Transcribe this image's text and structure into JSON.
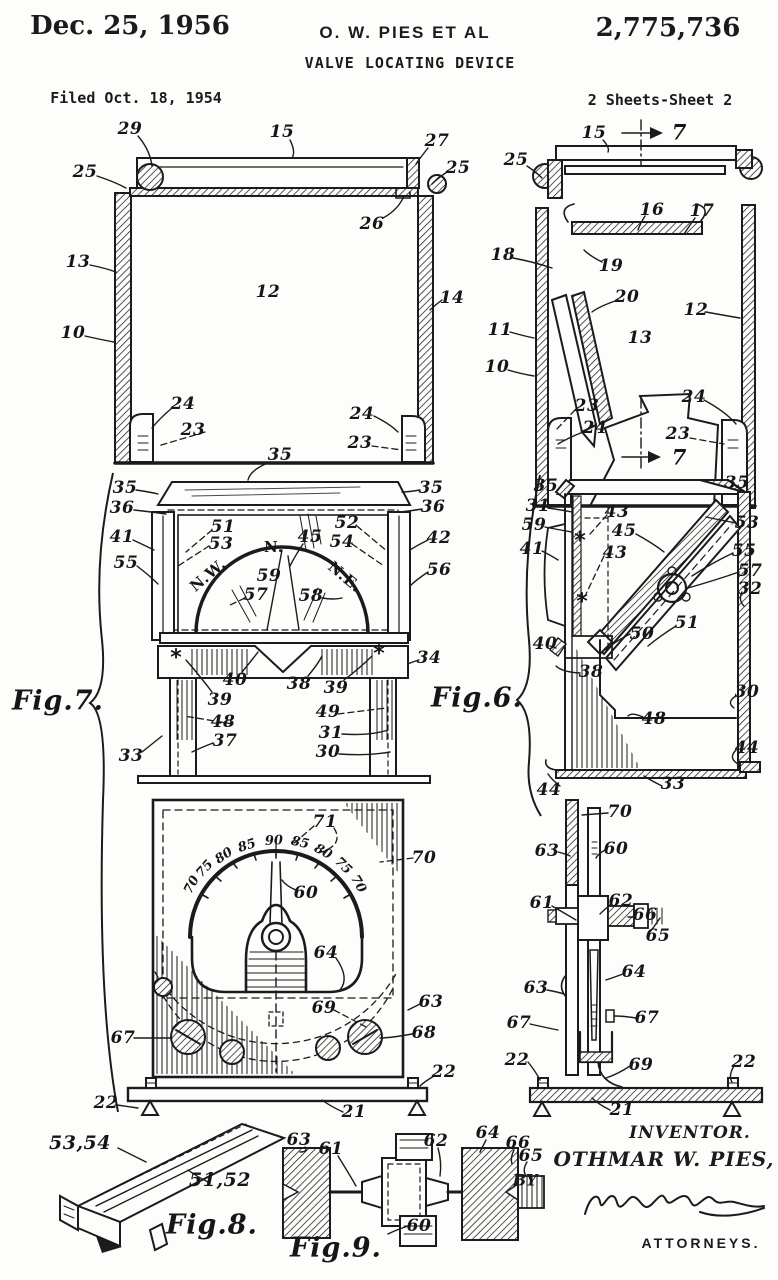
{
  "header": {
    "date": "Dec. 25, 1956",
    "inventor_line": "O. W. PIES ET AL",
    "patent_number": "2,775,736",
    "title": "VALVE LOCATING DEVICE",
    "filed": "Filed Oct. 18, 1954",
    "sheet": "2 Sheets-Sheet 2"
  },
  "inventor_block": {
    "label": "INVENTOR.",
    "name": "OTHMAR W. PIES,",
    "by": "BY",
    "attorneys": "ATTORNEYS."
  },
  "figure_titles": [
    "Fig.7.",
    "Fig.6.",
    "Fig.8.",
    "Fig.9."
  ],
  "labels": [
    {
      "t": "29",
      "x": 130,
      "y": 129
    },
    {
      "t": "15",
      "x": 282,
      "y": 132
    },
    {
      "t": "27",
      "x": 437,
      "y": 141
    },
    {
      "t": "25",
      "x": 85,
      "y": 172
    },
    {
      "t": "25",
      "x": 458,
      "y": 168
    },
    {
      "t": "26",
      "x": 372,
      "y": 224
    },
    {
      "t": "13",
      "x": 78,
      "y": 262
    },
    {
      "t": "12",
      "x": 268,
      "y": 292
    },
    {
      "t": "14",
      "x": 452,
      "y": 298
    },
    {
      "t": "10",
      "x": 73,
      "y": 333
    },
    {
      "t": "24",
      "x": 183,
      "y": 404
    },
    {
      "t": "23",
      "x": 193,
      "y": 430
    },
    {
      "t": "24",
      "x": 362,
      "y": 414
    },
    {
      "t": "23",
      "x": 360,
      "y": 443
    },
    {
      "t": "35",
      "x": 280,
      "y": 455
    },
    {
      "t": "15",
      "x": 594,
      "y": 133
    },
    {
      "t": "7",
      "x": 679,
      "y": 132,
      "c": "sec"
    },
    {
      "t": "25",
      "x": 516,
      "y": 160
    },
    {
      "t": "16",
      "x": 652,
      "y": 210
    },
    {
      "t": "17",
      "x": 702,
      "y": 211
    },
    {
      "t": "18",
      "x": 503,
      "y": 255
    },
    {
      "t": "19",
      "x": 611,
      "y": 266
    },
    {
      "t": "20",
      "x": 627,
      "y": 297
    },
    {
      "t": "12",
      "x": 696,
      "y": 310
    },
    {
      "t": "11",
      "x": 500,
      "y": 330
    },
    {
      "t": "13",
      "x": 640,
      "y": 338
    },
    {
      "t": "10",
      "x": 497,
      "y": 367
    },
    {
      "t": "23",
      "x": 587,
      "y": 406
    },
    {
      "t": "24",
      "x": 595,
      "y": 428
    },
    {
      "t": "24",
      "x": 694,
      "y": 397
    },
    {
      "t": "23",
      "x": 678,
      "y": 434
    },
    {
      "t": "7",
      "x": 679,
      "y": 457,
      "c": "sec"
    },
    {
      "t": "35",
      "x": 125,
      "y": 488
    },
    {
      "t": "36",
      "x": 122,
      "y": 508
    },
    {
      "t": "35",
      "x": 431,
      "y": 488
    },
    {
      "t": "36",
      "x": 433,
      "y": 507
    },
    {
      "t": "41",
      "x": 122,
      "y": 537
    },
    {
      "t": "51",
      "x": 223,
      "y": 527
    },
    {
      "t": "53",
      "x": 221,
      "y": 544
    },
    {
      "t": "45",
      "x": 310,
      "y": 537
    },
    {
      "t": "52",
      "x": 347,
      "y": 523
    },
    {
      "t": "54",
      "x": 342,
      "y": 542
    },
    {
      "t": "42",
      "x": 439,
      "y": 538
    },
    {
      "t": "55",
      "x": 126,
      "y": 563
    },
    {
      "t": "56",
      "x": 439,
      "y": 570
    },
    {
      "t": "N.",
      "x": 274,
      "y": 547,
      "c": "compass"
    },
    {
      "t": "N.W.",
      "x": 208,
      "y": 575,
      "c": "compass",
      "r": -40
    },
    {
      "t": "N.E.",
      "x": 345,
      "y": 577,
      "c": "compass",
      "r": 40
    },
    {
      "t": "59",
      "x": 269,
      "y": 576
    },
    {
      "t": "57",
      "x": 256,
      "y": 595
    },
    {
      "t": "58",
      "x": 311,
      "y": 596
    },
    {
      "t": "*",
      "x": 176,
      "y": 658,
      "c": "mark"
    },
    {
      "t": "*",
      "x": 379,
      "y": 654,
      "c": "mark"
    },
    {
      "t": "34",
      "x": 429,
      "y": 658
    },
    {
      "t": "40",
      "x": 235,
      "y": 680
    },
    {
      "t": "38",
      "x": 299,
      "y": 684
    },
    {
      "t": "39",
      "x": 336,
      "y": 688
    },
    {
      "t": "39",
      "x": 220,
      "y": 700
    },
    {
      "t": "49",
      "x": 328,
      "y": 712
    },
    {
      "t": "48",
      "x": 223,
      "y": 722
    },
    {
      "t": "31",
      "x": 331,
      "y": 733
    },
    {
      "t": "37",
      "x": 225,
      "y": 741
    },
    {
      "t": "30",
      "x": 328,
      "y": 752
    },
    {
      "t": "33",
      "x": 131,
      "y": 756
    },
    {
      "t": "Fig.7.",
      "x": 58,
      "y": 701,
      "c": "fig"
    },
    {
      "t": "Fig.6.",
      "x": 477,
      "y": 698,
      "c": "fig"
    },
    {
      "t": "35",
      "x": 546,
      "y": 486
    },
    {
      "t": "35",
      "x": 737,
      "y": 483
    },
    {
      "t": "31",
      "x": 538,
      "y": 506
    },
    {
      "t": "59",
      "x": 534,
      "y": 525
    },
    {
      "t": "41",
      "x": 532,
      "y": 549
    },
    {
      "t": "43",
      "x": 617,
      "y": 512
    },
    {
      "t": "45",
      "x": 624,
      "y": 531
    },
    {
      "t": "43",
      "x": 615,
      "y": 553
    },
    {
      "t": "53",
      "x": 747,
      "y": 523
    },
    {
      "t": "55",
      "x": 744,
      "y": 551
    },
    {
      "t": "57",
      "x": 750,
      "y": 571
    },
    {
      "t": "32",
      "x": 750,
      "y": 589
    },
    {
      "t": "*",
      "x": 580,
      "y": 541,
      "c": "mark"
    },
    {
      "t": "*",
      "x": 582,
      "y": 602,
      "c": "mark"
    },
    {
      "t": "51",
      "x": 687,
      "y": 623
    },
    {
      "t": "50",
      "x": 642,
      "y": 634
    },
    {
      "t": "40",
      "x": 545,
      "y": 644
    },
    {
      "t": "38",
      "x": 591,
      "y": 672
    },
    {
      "t": "30",
      "x": 747,
      "y": 692
    },
    {
      "t": "48",
      "x": 654,
      "y": 719
    },
    {
      "t": "44",
      "x": 747,
      "y": 748
    },
    {
      "t": "33",
      "x": 673,
      "y": 784
    },
    {
      "t": "44",
      "x": 549,
      "y": 790
    },
    {
      "t": "70",
      "x": 620,
      "y": 812
    },
    {
      "t": "63",
      "x": 547,
      "y": 851
    },
    {
      "t": "60",
      "x": 616,
      "y": 849
    },
    {
      "t": "61",
      "x": 542,
      "y": 903
    },
    {
      "t": "62",
      "x": 621,
      "y": 901
    },
    {
      "t": "66",
      "x": 645,
      "y": 915
    },
    {
      "t": "65",
      "x": 658,
      "y": 936
    },
    {
      "t": "64",
      "x": 634,
      "y": 972
    },
    {
      "t": "63",
      "x": 536,
      "y": 988
    },
    {
      "t": "67",
      "x": 519,
      "y": 1023
    },
    {
      "t": "67",
      "x": 647,
      "y": 1018
    },
    {
      "t": "69",
      "x": 641,
      "y": 1065
    },
    {
      "t": "22",
      "x": 744,
      "y": 1062
    },
    {
      "t": "22",
      "x": 517,
      "y": 1060
    },
    {
      "t": "21",
      "x": 622,
      "y": 1110
    },
    {
      "t": "71",
      "x": 325,
      "y": 822
    },
    {
      "t": "70",
      "x": 424,
      "y": 858
    },
    {
      "t": "60",
      "x": 306,
      "y": 893
    },
    {
      "t": "64",
      "x": 326,
      "y": 953
    },
    {
      "t": "69",
      "x": 324,
      "y": 1008
    },
    {
      "t": "63",
      "x": 431,
      "y": 1002
    },
    {
      "t": "67",
      "x": 123,
      "y": 1038
    },
    {
      "t": "68",
      "x": 424,
      "y": 1033
    },
    {
      "t": "22",
      "x": 444,
      "y": 1072
    },
    {
      "t": "22",
      "x": 106,
      "y": 1103
    },
    {
      "t": "21",
      "x": 354,
      "y": 1112
    },
    {
      "t": "70",
      "x": 192,
      "y": 885,
      "c": "dial",
      "r": -62
    },
    {
      "t": "75",
      "x": 205,
      "y": 869,
      "c": "dial",
      "r": -48
    },
    {
      "t": "80",
      "x": 224,
      "y": 856,
      "c": "dial",
      "r": -34
    },
    {
      "t": "85",
      "x": 247,
      "y": 846,
      "c": "dial",
      "r": -18
    },
    {
      "t": "90",
      "x": 274,
      "y": 841,
      "c": "dial",
      "r": -3
    },
    {
      "t": "85",
      "x": 300,
      "y": 843,
      "c": "dial",
      "r": 13
    },
    {
      "t": "80",
      "x": 323,
      "y": 852,
      "c": "dial",
      "r": 29
    },
    {
      "t": "75",
      "x": 343,
      "y": 866,
      "c": "dial",
      "r": 45
    },
    {
      "t": "70",
      "x": 358,
      "y": 884,
      "c": "dial",
      "r": 60
    },
    {
      "t": "53,54",
      "x": 80,
      "y": 1143,
      "s": 19
    },
    {
      "t": "51,52",
      "x": 220,
      "y": 1180,
      "s": 19
    },
    {
      "t": "Fig.8.",
      "x": 212,
      "y": 1225,
      "c": "fig"
    },
    {
      "t": "63",
      "x": 299,
      "y": 1140
    },
    {
      "t": "61",
      "x": 331,
      "y": 1149
    },
    {
      "t": "62",
      "x": 436,
      "y": 1141
    },
    {
      "t": "64",
      "x": 488,
      "y": 1133
    },
    {
      "t": "66",
      "x": 518,
      "y": 1143
    },
    {
      "t": "65",
      "x": 531,
      "y": 1156
    },
    {
      "t": "60",
      "x": 419,
      "y": 1226
    },
    {
      "t": "Fig.9.",
      "x": 336,
      "y": 1248,
      "c": "fig"
    }
  ]
}
